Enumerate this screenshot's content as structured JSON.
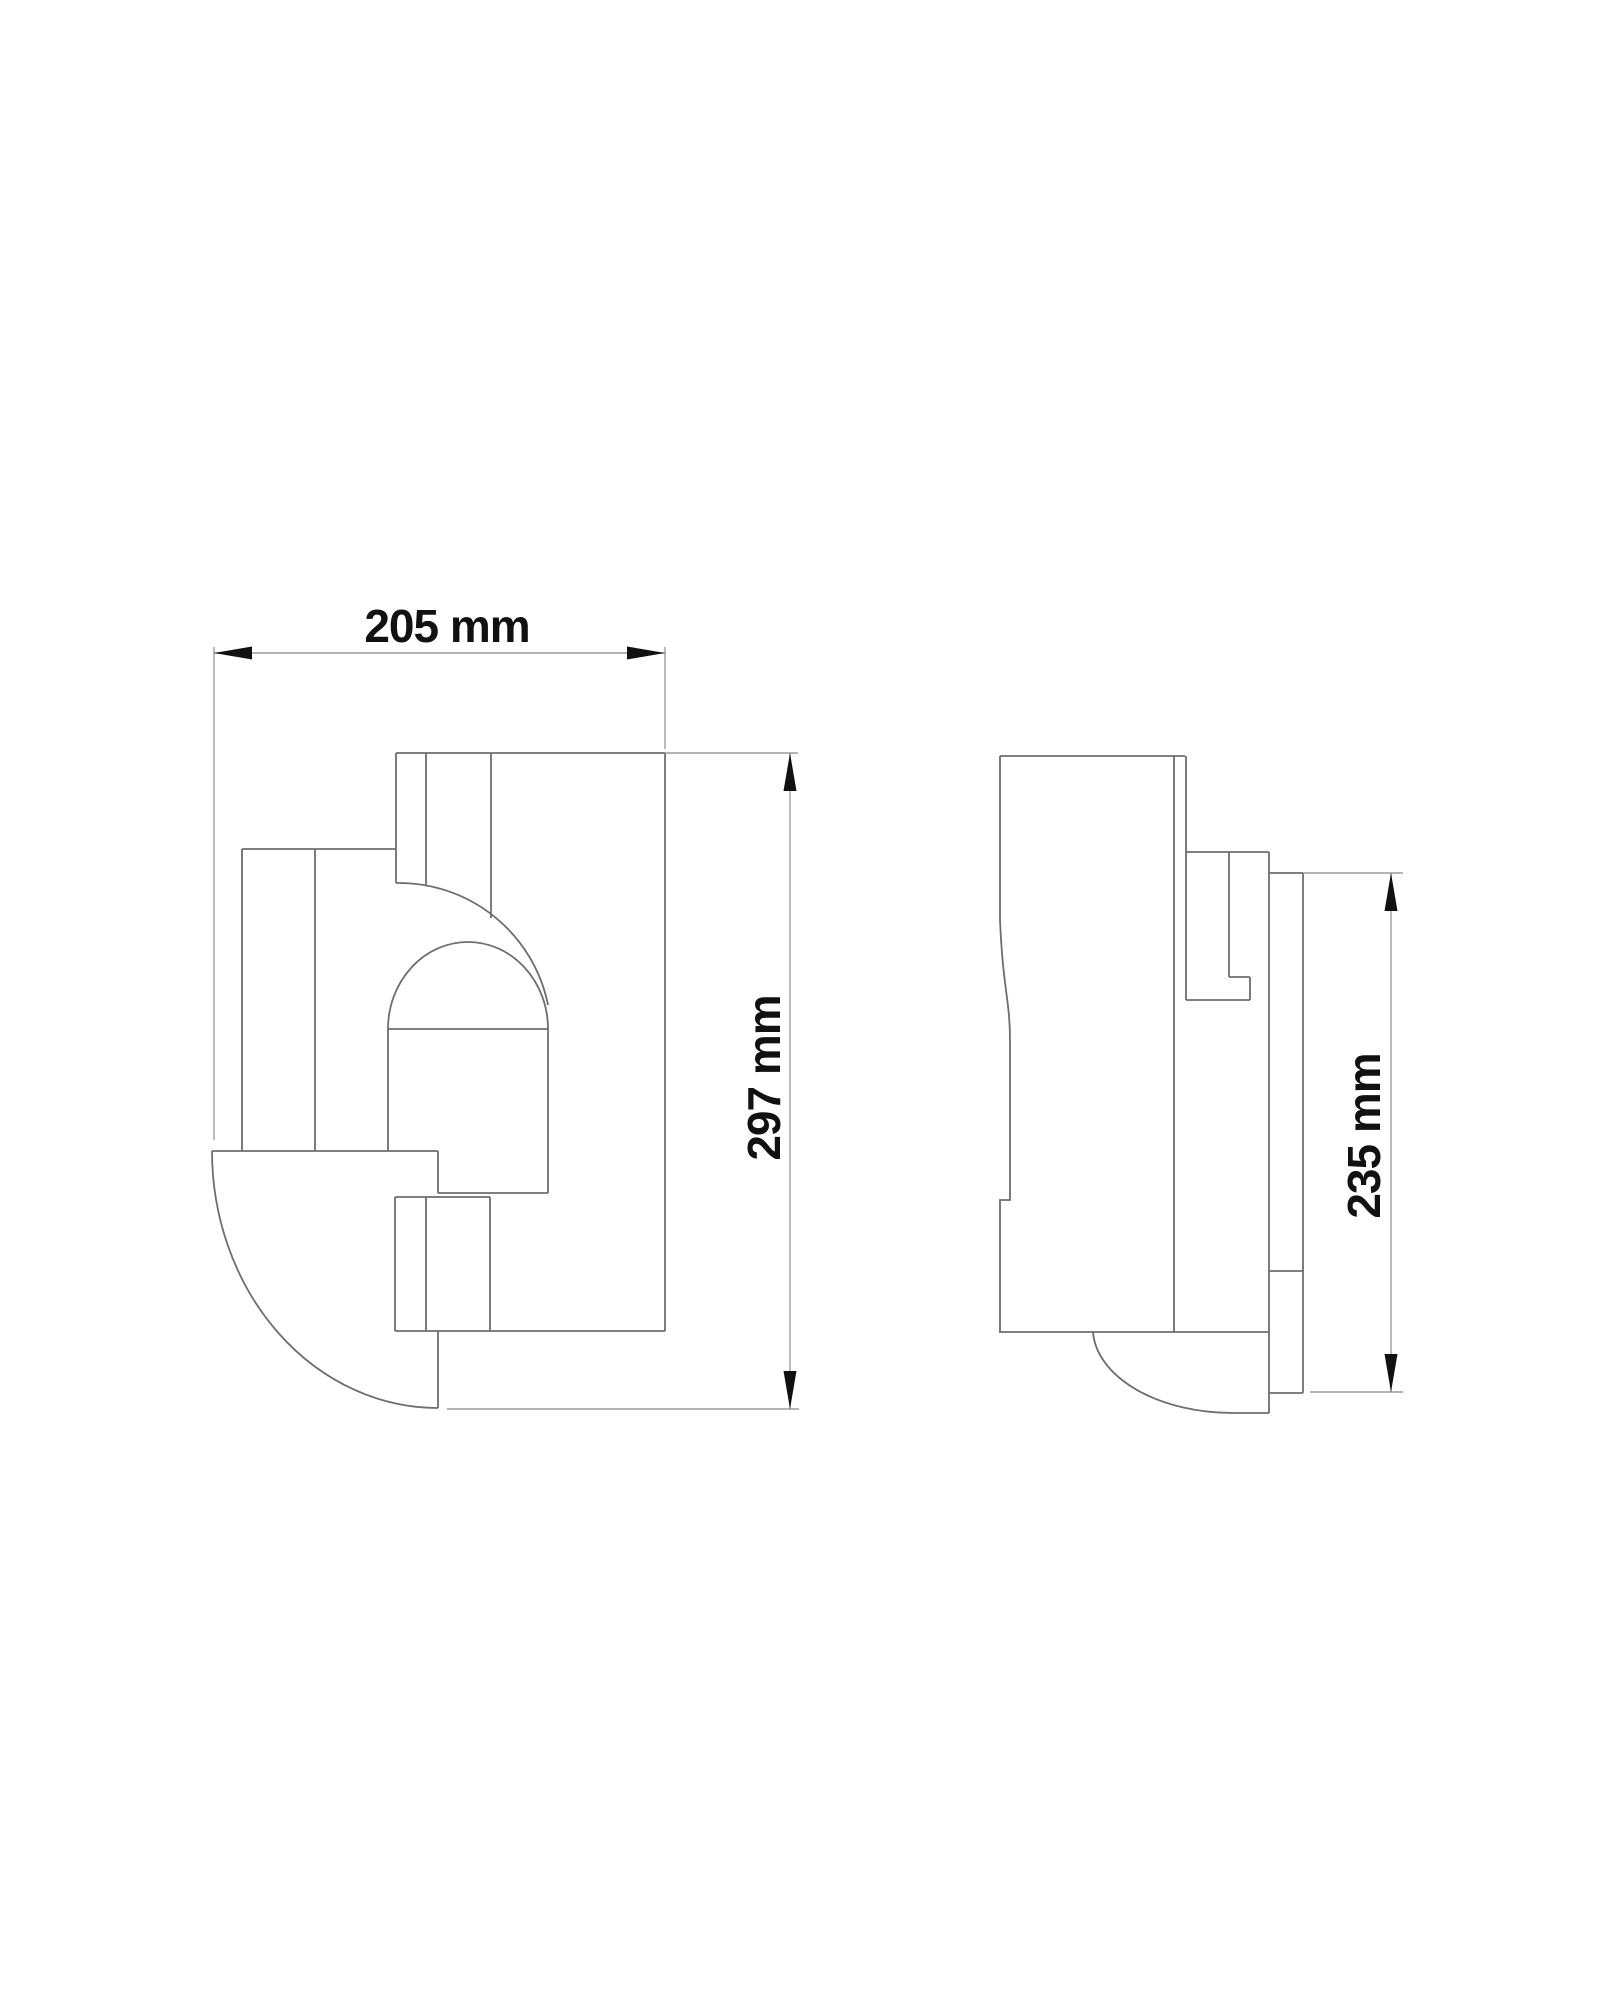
{
  "drawing": {
    "description": "Two-view technical dimension drawing of a wall lamp",
    "views": [
      {
        "id": "front-view",
        "position": "left"
      },
      {
        "id": "side-view",
        "position": "right"
      }
    ],
    "dimensions": {
      "front_width": {
        "label": "205 mm",
        "orientation": "horizontal"
      },
      "front_height": {
        "label": "297 mm",
        "orientation": "vertical"
      },
      "side_height": {
        "label": "235 mm",
        "orientation": "vertical"
      }
    }
  },
  "colors": {
    "background": "#ffffff",
    "drawing_line": "#6e6e6e",
    "dimension_line": "#9c9c9c",
    "annotation": "#111111"
  }
}
